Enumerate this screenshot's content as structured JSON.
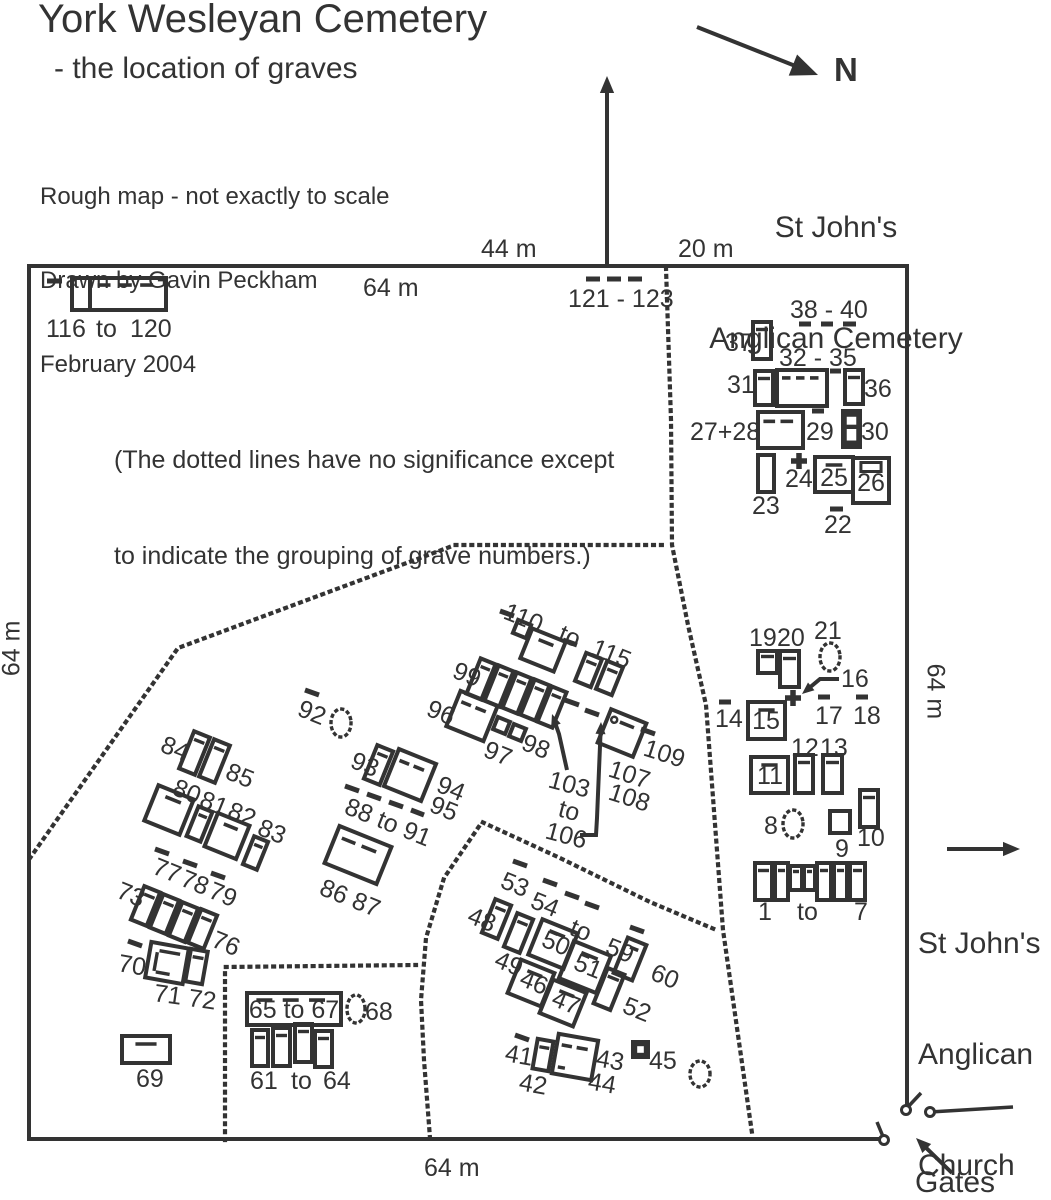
{
  "title": "York Wesleyan Cemetery",
  "subtitle": "- the location of graves",
  "credit": [
    "Rough map - not exactly to scale",
    "Drawn by Gavin Peckham",
    "February 2004"
  ],
  "note": [
    "(The dotted lines have no significance except",
    "to indicate the grouping of grave numbers.)"
  ],
  "neighbor": [
    "St John's",
    "Anglican Cemetery"
  ],
  "church": [
    "St John's",
    "Anglican",
    "Church"
  ],
  "compass_label": "N",
  "gates_label": "Gates",
  "measurements": {
    "top_mid": "44 m",
    "top_right": "20 m",
    "top_inner": "64 m",
    "left": "64 m",
    "right": "64 m",
    "bottom": "64 m"
  },
  "colors": {
    "ink": "#333333"
  },
  "map": {
    "border": [
      [
        883,
        1139
      ],
      [
        29,
        1139
      ],
      [
        29,
        266
      ],
      [
        907,
        266
      ],
      [
        907,
        1108
      ]
    ],
    "dotted": [
      [
        [
          666,
          268
        ],
        [
          671,
          420
        ],
        [
          672,
          545
        ],
        [
          688,
          625
        ],
        [
          706,
          705
        ],
        [
          723,
          930
        ],
        [
          752,
          1133
        ]
      ],
      [
        [
          30,
          858
        ],
        [
          178,
          648
        ],
        [
          455,
          545
        ],
        [
          668,
          545
        ]
      ],
      [
        [
          430,
          1138
        ],
        [
          424,
          1060
        ],
        [
          421,
          1000
        ],
        [
          426,
          938
        ],
        [
          444,
          878
        ],
        [
          482,
          822
        ],
        [
          560,
          858
        ],
        [
          650,
          902
        ],
        [
          714,
          929
        ]
      ],
      [
        [
          225,
          1140
        ],
        [
          225,
          967
        ],
        [
          416,
          965
        ]
      ]
    ],
    "rects": [
      [
        72,
        278,
        18,
        32,
        0,
        0
      ],
      [
        90,
        278,
        76,
        32,
        0,
        4
      ],
      [
        753,
        322,
        18,
        37,
        0,
        1
      ],
      [
        755,
        371,
        18,
        34,
        0,
        1
      ],
      [
        777,
        370,
        50,
        36,
        0,
        4
      ],
      [
        845,
        370,
        18,
        34,
        0,
        1
      ],
      [
        758,
        412,
        45,
        36,
        0,
        3
      ],
      [
        843,
        411,
        17,
        36,
        0,
        5
      ],
      [
        758,
        455,
        16,
        37,
        0,
        0
      ],
      [
        815,
        457,
        38,
        35,
        0,
        2
      ],
      [
        853,
        458,
        36,
        45,
        0,
        8
      ],
      [
        758,
        651,
        19,
        22,
        0,
        1
      ],
      [
        780,
        651,
        19,
        36,
        0,
        1
      ],
      [
        748,
        702,
        37,
        37,
        0,
        2
      ],
      [
        751,
        757,
        37,
        36,
        0,
        2
      ],
      [
        795,
        755,
        18,
        38,
        0,
        1
      ],
      [
        823,
        755,
        19,
        38,
        0,
        1
      ],
      [
        830,
        811,
        20,
        22,
        0,
        0
      ],
      [
        860,
        790,
        18,
        37,
        0,
        1
      ],
      [
        755,
        863,
        17,
        37,
        0,
        1
      ],
      [
        775,
        863,
        13,
        37,
        0,
        1
      ],
      [
        790,
        866,
        12,
        24,
        0,
        1
      ],
      [
        804,
        866,
        11,
        24,
        0,
        1
      ],
      [
        817,
        863,
        14,
        37,
        0,
        1
      ],
      [
        834,
        863,
        13,
        37,
        0,
        1
      ],
      [
        850,
        863,
        15,
        37,
        0,
        1
      ],
      [
        515,
        622,
        14,
        14,
        22,
        0
      ],
      [
        525,
        634,
        36,
        32,
        22,
        2
      ],
      [
        580,
        655,
        17,
        30,
        22,
        1
      ],
      [
        601,
        663,
        17,
        30,
        22,
        1
      ],
      [
        473,
        660,
        16,
        38,
        22,
        1
      ],
      [
        491,
        667,
        16,
        38,
        22,
        1
      ],
      [
        509,
        674,
        16,
        38,
        22,
        1
      ],
      [
        527,
        681,
        16,
        38,
        22,
        1
      ],
      [
        544,
        688,
        16,
        38,
        22,
        1
      ],
      [
        452,
        697,
        40,
        38,
        22,
        3
      ],
      [
        495,
        719,
        13,
        13,
        22,
        0
      ],
      [
        511,
        726,
        13,
        13,
        22,
        0
      ],
      [
        603,
        715,
        38,
        36,
        22,
        7
      ],
      [
        186,
        733,
        17,
        40,
        22,
        1
      ],
      [
        206,
        741,
        17,
        40,
        22,
        1
      ],
      [
        150,
        791,
        38,
        38,
        22,
        2
      ],
      [
        192,
        808,
        15,
        32,
        22,
        1
      ],
      [
        210,
        818,
        34,
        36,
        22,
        2
      ],
      [
        248,
        838,
        15,
        30,
        22,
        1
      ],
      [
        370,
        747,
        17,
        36,
        22,
        1
      ],
      [
        390,
        755,
        40,
        40,
        22,
        3
      ],
      [
        330,
        835,
        56,
        40,
        22,
        3
      ],
      [
        137,
        888,
        17,
        36,
        22,
        1
      ],
      [
        156,
        896,
        17,
        36,
        22,
        1
      ],
      [
        175,
        904,
        17,
        36,
        22,
        1
      ],
      [
        194,
        911,
        17,
        36,
        22,
        1
      ],
      [
        148,
        945,
        38,
        36,
        10,
        9
      ],
      [
        188,
        950,
        17,
        33,
        10,
        1
      ],
      [
        122,
        1036,
        48,
        27,
        0,
        2
      ],
      [
        247,
        993,
        94,
        32,
        0,
        4
      ],
      [
        252,
        1030,
        16,
        36,
        0,
        1
      ],
      [
        273,
        1028,
        17,
        38,
        0,
        1
      ],
      [
        295,
        1024,
        17,
        38,
        0,
        1
      ],
      [
        315,
        1031,
        17,
        36,
        0,
        1
      ],
      [
        488,
        901,
        17,
        36,
        22,
        1
      ],
      [
        510,
        915,
        17,
        36,
        22,
        1
      ],
      [
        534,
        925,
        38,
        38,
        22,
        2
      ],
      [
        565,
        947,
        40,
        40,
        22,
        2
      ],
      [
        620,
        940,
        20,
        38,
        22,
        2
      ],
      [
        600,
        970,
        18,
        38,
        22,
        1
      ],
      [
        513,
        965,
        36,
        36,
        22,
        2
      ],
      [
        545,
        985,
        36,
        36,
        22,
        2
      ],
      [
        535,
        1040,
        16,
        30,
        10,
        1
      ],
      [
        555,
        1037,
        40,
        40,
        10,
        10
      ],
      [
        633,
        1042,
        15,
        15,
        0,
        6
      ]
    ],
    "dashes": [
      [
        47,
        281,
        62,
        281
      ],
      [
        586,
        279,
        600,
        279
      ],
      [
        607,
        279,
        621,
        279
      ],
      [
        628,
        279,
        642,
        279
      ],
      [
        799,
        324,
        811,
        324
      ],
      [
        821,
        324,
        833,
        324
      ],
      [
        843,
        324,
        856,
        324
      ],
      [
        830,
        371,
        841,
        371
      ],
      [
        812,
        411,
        824,
        411
      ],
      [
        830,
        509,
        843,
        509
      ],
      [
        719,
        702,
        731,
        702
      ],
      [
        818,
        697,
        830,
        697
      ],
      [
        856,
        697,
        868,
        697
      ],
      [
        500,
        611,
        514,
        616
      ],
      [
        563,
        640,
        577,
        645
      ],
      [
        565,
        700,
        579,
        705
      ],
      [
        585,
        710,
        599,
        715
      ],
      [
        641,
        729,
        655,
        734
      ],
      [
        305,
        690,
        319,
        695
      ],
      [
        345,
        786,
        359,
        791
      ],
      [
        367,
        794,
        381,
        799
      ],
      [
        389,
        802,
        403,
        807
      ],
      [
        411,
        810,
        424,
        815
      ],
      [
        155,
        849,
        169,
        854
      ],
      [
        183,
        861,
        197,
        866
      ],
      [
        211,
        873,
        225,
        878
      ],
      [
        128,
        941,
        142,
        946
      ],
      [
        513,
        861,
        527,
        866
      ],
      [
        543,
        880,
        557,
        885
      ],
      [
        565,
        893,
        579,
        898
      ],
      [
        585,
        903,
        599,
        908
      ],
      [
        630,
        927,
        644,
        932
      ],
      [
        515,
        1035,
        529,
        1040
      ]
    ],
    "ellipses": [
      [
        830,
        657,
        10,
        14
      ],
      [
        793,
        824,
        10,
        14
      ],
      [
        341,
        723,
        10,
        14
      ],
      [
        356,
        1009,
        9,
        14
      ],
      [
        700,
        1074,
        10,
        13
      ]
    ],
    "plus": [
      [
        799,
        461
      ],
      [
        793,
        698
      ]
    ],
    "arrows": [
      {
        "n": "north-arrow",
        "p": [
          [
            697,
            27
          ],
          [
            818,
            75
          ]
        ],
        "hs": 27
      },
      {
        "n": "up-arrow",
        "p": [
          [
            607,
            266
          ],
          [
            607,
            76
          ]
        ],
        "hs": 17
      },
      {
        "n": "church-arrow",
        "p": [
          [
            947,
            849
          ],
          [
            1020,
            849
          ]
        ],
        "hs": 17
      },
      {
        "n": "gates-arrow",
        "p": [
          [
            952,
            1173
          ],
          [
            916,
            1138
          ]
        ],
        "hs": 15
      },
      {
        "n": "label-16-arrow",
        "p": [
          [
            839,
            679
          ],
          [
            820,
            679
          ],
          [
            802,
            694
          ]
        ],
        "hs": 12
      },
      {
        "n": "label-103-arrow",
        "p": [
          [
            567,
            770
          ],
          [
            559,
            734
          ],
          [
            552,
            714
          ]
        ],
        "hs": 12
      },
      {
        "n": "label-106-arrow",
        "p": [
          [
            580,
            835
          ],
          [
            596,
            835
          ],
          [
            597,
            818
          ],
          [
            601,
            722
          ]
        ],
        "hs": 12
      }
    ],
    "gates": {
      "ticks": [
        [
          906,
          1109,
          921,
          1093
        ],
        [
          884,
          1139,
          877,
          1122
        ]
      ],
      "bar": [
        930,
        1112,
        1013,
        1107
      ],
      "circles": [
        [
          906,
          1110
        ],
        [
          930,
          1112
        ],
        [
          884,
          1140
        ]
      ]
    },
    "labels": [
      [
        "116",
        46,
        337
      ],
      [
        "to",
        96,
        337
      ],
      [
        "120",
        130,
        337
      ],
      [
        "121 - 123",
        568,
        307
      ],
      [
        "37",
        725,
        351
      ],
      [
        "38 - 40",
        790,
        318
      ],
      [
        "31",
        727,
        393
      ],
      [
        "32 - 35",
        779,
        366
      ],
      [
        "36",
        864,
        397
      ],
      [
        "27+28",
        690,
        440
      ],
      [
        "29",
        806,
        440
      ],
      [
        "30",
        861,
        440
      ],
      [
        "23",
        752,
        514
      ],
      [
        "24",
        785,
        487
      ],
      [
        "25",
        834,
        486,
        0,
        "m"
      ],
      [
        "26",
        871,
        491,
        0,
        "m"
      ],
      [
        "22",
        824,
        533
      ],
      [
        "19",
        749,
        646
      ],
      [
        "20",
        777,
        646
      ],
      [
        "21",
        814,
        639
      ],
      [
        "16",
        841,
        687
      ],
      [
        "14",
        715,
        727
      ],
      [
        "15",
        766,
        729,
        0,
        "m"
      ],
      [
        "17",
        815,
        724
      ],
      [
        "18",
        853,
        724
      ],
      [
        "12",
        791,
        756
      ],
      [
        "13",
        820,
        756
      ],
      [
        "11",
        770,
        784,
        0,
        "m"
      ],
      [
        "8",
        764,
        834
      ],
      [
        "9",
        835,
        857
      ],
      [
        "10",
        857,
        846
      ],
      [
        "1",
        758,
        920
      ],
      [
        "to",
        797,
        920
      ],
      [
        "7",
        854,
        920
      ],
      [
        "110",
        502,
        618,
        22
      ],
      [
        "to",
        557,
        640,
        22
      ],
      [
        "115",
        590,
        654,
        22
      ],
      [
        "99",
        451,
        677,
        22
      ],
      [
        "96",
        425,
        715,
        22
      ],
      [
        "97",
        482,
        756,
        22
      ],
      [
        "98",
        520,
        749,
        22
      ],
      [
        "109",
        642,
        755,
        18
      ],
      [
        "107",
        607,
        776,
        18
      ],
      [
        "108",
        607,
        799,
        18
      ],
      [
        "103",
        547,
        787,
        15
      ],
      [
        "to",
        557,
        816,
        15
      ],
      [
        "106",
        544,
        838,
        15
      ],
      [
        "92",
        296,
        715,
        22
      ],
      [
        "93",
        349,
        767,
        22
      ],
      [
        "94",
        435,
        791,
        22
      ],
      [
        "95",
        428,
        811,
        22
      ],
      [
        "88 to 91",
        343,
        813,
        22
      ],
      [
        "84",
        159,
        751,
        22
      ],
      [
        "85",
        224,
        778,
        22
      ],
      [
        "80",
        171,
        794,
        22
      ],
      [
        "81",
        198,
        806,
        22
      ],
      [
        "82",
        226,
        817,
        22
      ],
      [
        "83",
        256,
        834,
        22
      ],
      [
        "86 87",
        318,
        894,
        22
      ],
      [
        "77",
        151,
        873,
        22
      ],
      [
        "78",
        179,
        885,
        22
      ],
      [
        "79",
        207,
        897,
        22
      ],
      [
        "73",
        115,
        897,
        22
      ],
      [
        "76",
        210,
        946,
        22
      ],
      [
        "70",
        117,
        971,
        10
      ],
      [
        "71 72",
        153,
        1001,
        8
      ],
      [
        "69",
        136,
        1087
      ],
      [
        "61",
        250,
        1089
      ],
      [
        "to",
        291,
        1089
      ],
      [
        "64",
        323,
        1089
      ],
      [
        "65 to 67",
        294,
        1018,
        0,
        "m"
      ],
      [
        "68",
        365,
        1020
      ],
      [
        "53",
        499,
        887,
        22
      ],
      [
        "54",
        529,
        907,
        22
      ],
      [
        "to",
        568,
        934,
        22
      ],
      [
        "59",
        604,
        953,
        22
      ],
      [
        "48",
        466,
        922,
        22
      ],
      [
        "49",
        493,
        966,
        22
      ],
      [
        "50",
        553,
        951,
        22,
        "m"
      ],
      [
        "51",
        585,
        974,
        22,
        "m"
      ],
      [
        "46",
        531,
        990,
        22,
        "m"
      ],
      [
        "47",
        563,
        1010,
        22,
        "m"
      ],
      [
        "60",
        649,
        979,
        22
      ],
      [
        "52",
        621,
        1012,
        22
      ],
      [
        "41",
        504,
        1061,
        10
      ],
      [
        "42",
        518,
        1090,
        10
      ],
      [
        "43",
        595,
        1066,
        10
      ],
      [
        "44",
        587,
        1089,
        10
      ],
      [
        "45",
        649,
        1069
      ]
    ]
  }
}
